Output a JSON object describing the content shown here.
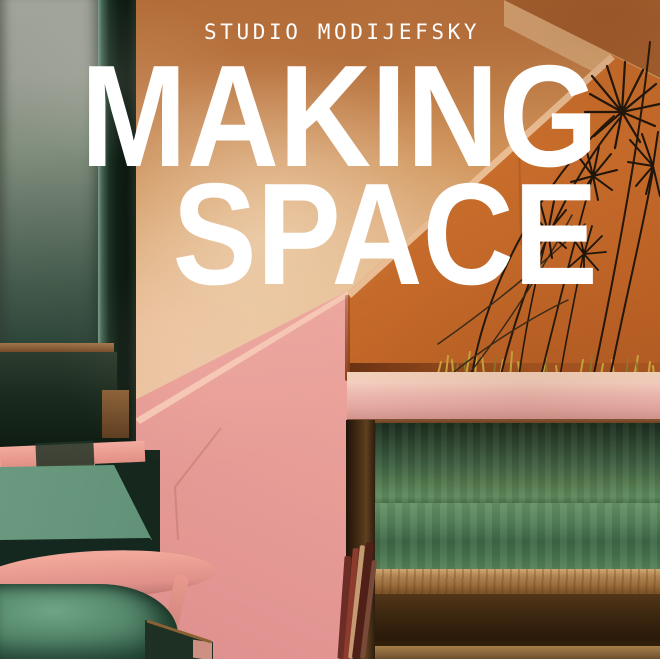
{
  "cover": {
    "studio_label": "STUDIO MODIJEFSKY",
    "title": {
      "line1": "MAKING",
      "line2": "SPACE"
    },
    "text_color": "#ffffff"
  },
  "palette": {
    "wall_orange_top": "#b96f3c",
    "wall_pale_plaster": "#e9cdb0",
    "understair_orange": "#c96f2c",
    "balustrade_pink": "#eca69e",
    "shelf_pink": "#e9b6ae",
    "velvet_green": "#55855f",
    "step_terrazzo_green": "#5f8f75",
    "step_nosing_pink": "#ec9d93",
    "bench_oak": "#a87c48",
    "bench_walnut": "#2b1b0d",
    "panel_grey_green": "#8d9488",
    "plant_stem_brown": "#26190d",
    "grass_yellow": "#c9a63e"
  }
}
